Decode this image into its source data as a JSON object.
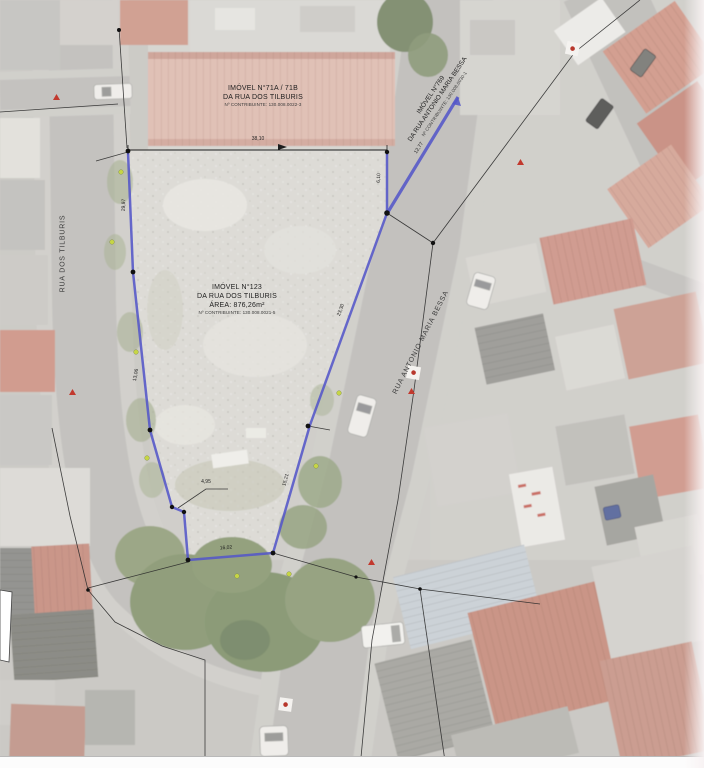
{
  "map": {
    "description": "Aerial survey plan of urban parcel with blue boundary overlay",
    "colors": {
      "boundary_blue": "#5456c8",
      "survey_black": "#2b2b2b",
      "marker_red": "#c2392e",
      "marker_yellow": "#c6d645",
      "roof_terracotta": "#c4887a",
      "asphalt": "#b8b6b2"
    }
  },
  "parcel_labels": {
    "imovel_71": {
      "l1": "IMÓVEL N°71A / 71B",
      "l2": "DA RUA DOS TILBURIS",
      "l3": "Nº CONTRIBUINTE: 130.008.0022-3"
    },
    "imovel_123": {
      "l1": "IMÓVEL N°123",
      "l2": "DA RUA DOS TILBURIS",
      "l3": "ÁREA: 876,26m²",
      "l4": "Nº CONTRIBUINTE: 130.008.0021-5"
    },
    "imovel_769": {
      "l1": "IMÓVEL N°769",
      "l2": "DA RUA ANTONIO MARIA BESSA",
      "l3": "Nº CONTRIBUINTE: 130.008.0030-1"
    }
  },
  "streets": {
    "left_vertical": "RUA DOS TILBURIS",
    "diagonal": "RUA ANTONIO MARIA BESSA"
  },
  "dimensions": [
    {
      "text": "38,10",
      "x": 258,
      "y": 139,
      "rot": 0
    },
    {
      "text": "29,97",
      "x": 124,
      "y": 205,
      "rot": -88
    },
    {
      "text": "13,06",
      "x": 136,
      "y": 375,
      "rot": -80
    },
    {
      "text": "6,10",
      "x": 379,
      "y": 178,
      "rot": -88
    },
    {
      "text": "23,30",
      "x": 341,
      "y": 310,
      "rot": -70
    },
    {
      "text": "15,21",
      "x": 286,
      "y": 480,
      "rot": -74
    },
    {
      "text": "16,02",
      "x": 226,
      "y": 548,
      "rot": -4
    },
    {
      "text": "4,95",
      "x": 206,
      "y": 482,
      "rot": 0
    },
    {
      "text": "12,77",
      "x": 419,
      "y": 148,
      "rot": -58
    }
  ]
}
